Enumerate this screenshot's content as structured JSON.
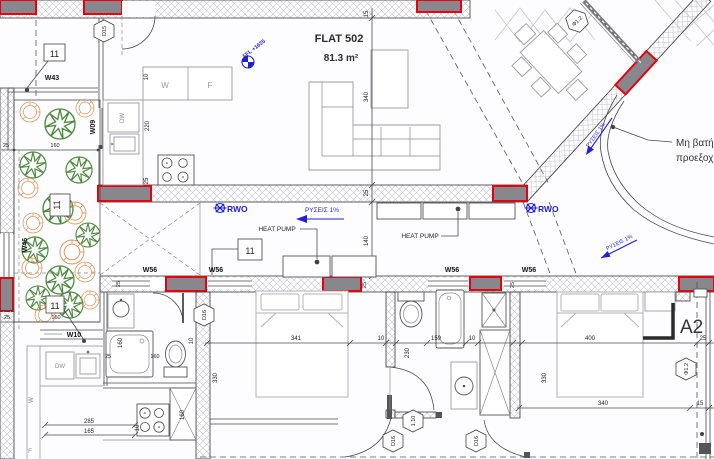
{
  "flat": {
    "name": "FLAT 502",
    "area": "81.3 m²"
  },
  "levels": {
    "ffl": "FFL +1635"
  },
  "notes": {
    "rwo": "RWO",
    "slope": "ΡΥΣΕΙΣ 1%",
    "heat_pump": "HEAT PUMP",
    "ledge_line1": "Μη βατή",
    "ledge_line2": "προεξοχή",
    "section": "A2"
  },
  "tags": {
    "d15": "D15",
    "d16": "D16",
    "d12": "Φ1.2",
    "d110": "1.10",
    "w43": "W43",
    "w46": "W46",
    "w09": "W09",
    "w10": "W10",
    "w56": "W56",
    "box": "11"
  },
  "appliances": {
    "washer": "W",
    "fridge": "F",
    "dishwasher": "DW"
  },
  "dims": {
    "10": "10",
    "15": "15",
    "25": "25",
    "140": "140",
    "159": "159",
    "160": "160",
    "165": "165",
    "220": "220",
    "230": "230",
    "285": "285",
    "330": "330",
    "340": "340",
    "341": "341",
    "400": "400"
  }
}
